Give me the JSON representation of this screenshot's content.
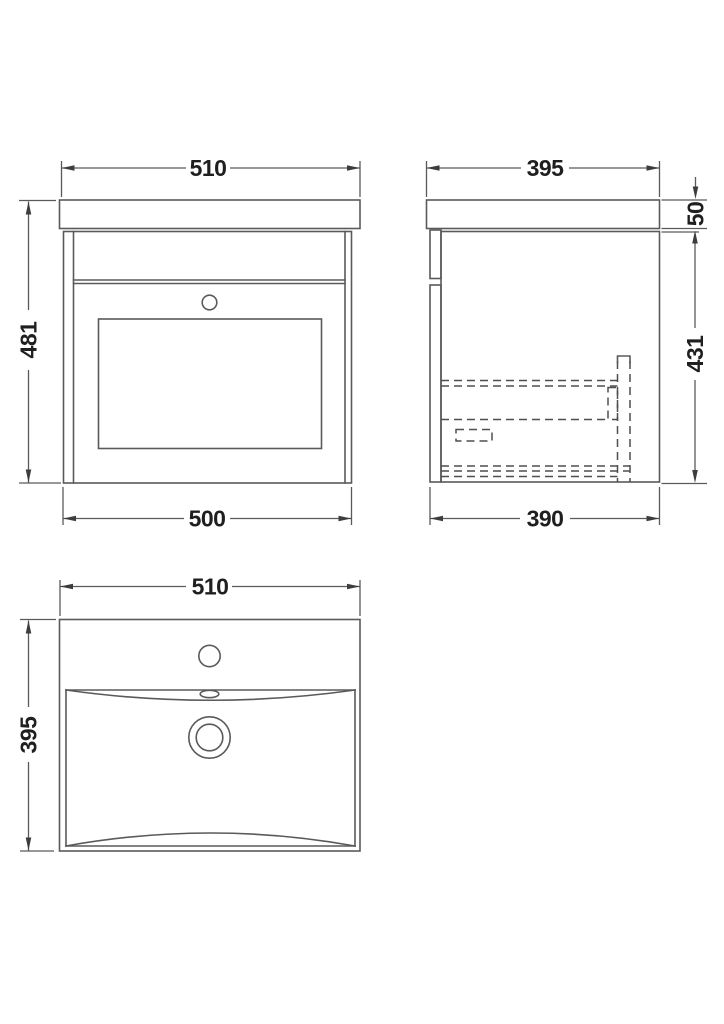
{
  "drawing": {
    "views": {
      "front": {
        "width_top": "510",
        "height": "481",
        "width_bottom": "500"
      },
      "side": {
        "depth_top": "395",
        "worktop_thickness": "50",
        "carcass_height": "431",
        "depth_bottom": "390"
      },
      "basin_plan": {
        "width": "510",
        "depth": "395"
      }
    }
  },
  "colors": {
    "line": "#5a5a5a",
    "dashed_line": "#4f4f4f",
    "text": "#1f1f1f",
    "arrow": "#3d3d3d",
    "background": "#ffffff"
  }
}
